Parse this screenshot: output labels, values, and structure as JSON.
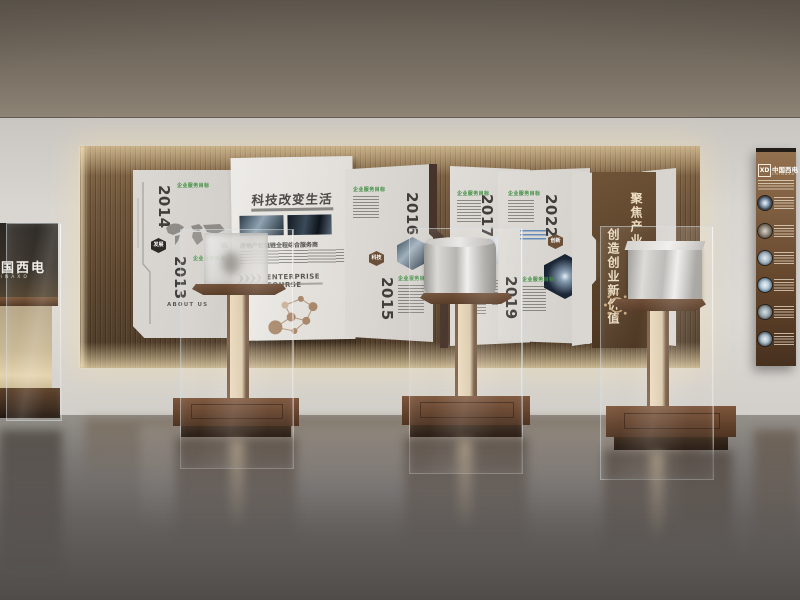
{
  "wall": {
    "section_header": "企业服务目标",
    "title_panel": {
      "title": "科技改变生活",
      "tagline": "房地产价值链全程综合服务商",
      "course_heading": "ENTERPRISE COURSE",
      "about_label": "ABOUT US"
    },
    "timeline": [
      {
        "year": "2014"
      },
      {
        "year": "2013"
      },
      {
        "year": "2016"
      },
      {
        "year": "2015"
      },
      {
        "year": "2017"
      },
      {
        "year": "2022"
      },
      {
        "year": "2019"
      }
    ],
    "badges": {
      "start": "发展",
      "tech": "科技",
      "innovation": "创新"
    },
    "slogan": {
      "line1": "聚焦产业互联网",
      "line2": "创造创业新价值"
    }
  },
  "brand_panel": {
    "logo": "XD",
    "name_cn": "中国西电",
    "name_en": "CHINAXD"
  },
  "cabinet": {
    "name_cn": "中国西电",
    "name_en": "CHINAXD"
  },
  "colors": {
    "header_green": "#3e8e41",
    "wood_brown": "#6b5138",
    "panel_brown": "#5e4530",
    "accent_blue": "#4a7ab5"
  }
}
